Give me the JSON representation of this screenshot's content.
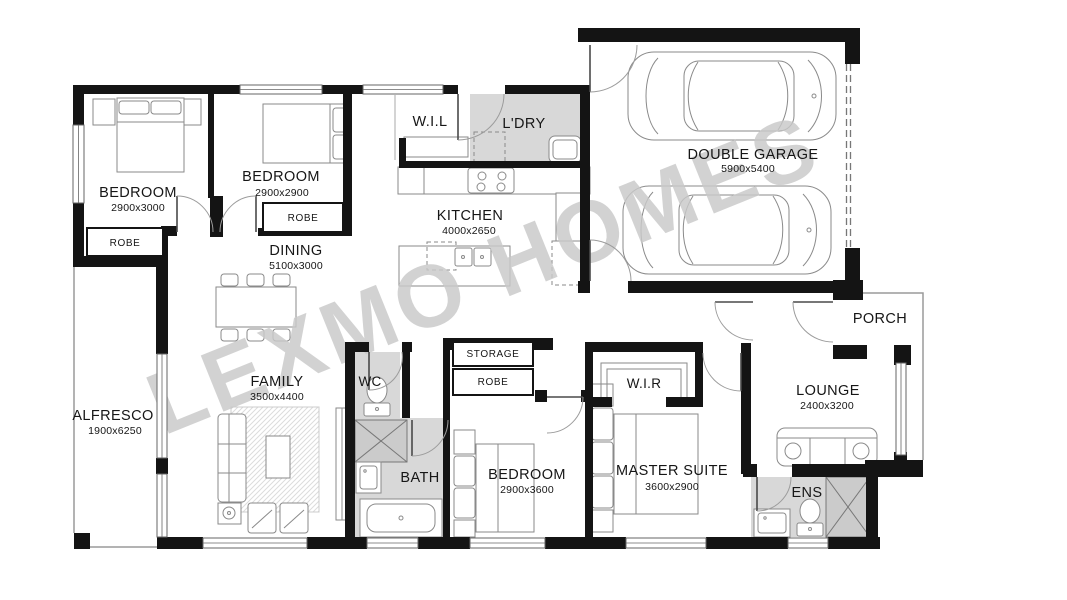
{
  "watermark": "LEXMO HOMES",
  "rooms": {
    "bedroom1": {
      "name": "BEDROOM",
      "dims": "2900x3000"
    },
    "bedroom2": {
      "name": "BEDROOM",
      "dims": "2900x2900"
    },
    "dining": {
      "name": "DINING",
      "dims": "5100x3000"
    },
    "wil": {
      "name": "W.I.L"
    },
    "ldry": {
      "name": "L'DRY"
    },
    "kitchen": {
      "name": "KITCHEN",
      "dims": "4000x2650"
    },
    "garage": {
      "name": "DOUBLE GARAGE",
      "dims": "5900x5400"
    },
    "alfresco": {
      "name": "ALFRESCO",
      "dims": "1900x6250"
    },
    "family": {
      "name": "FAMILY",
      "dims": "3500x4400"
    },
    "wc": {
      "name": "WC"
    },
    "storage": {
      "name": "STORAGE"
    },
    "robe_bed1": {
      "name": "ROBE"
    },
    "robe_bed2": {
      "name": "ROBE"
    },
    "robe_bed3": {
      "name": "ROBE"
    },
    "wir": {
      "name": "W.I.R"
    },
    "bath": {
      "name": "BATH"
    },
    "bedroom3": {
      "name": "BEDROOM",
      "dims": "2900x3600"
    },
    "master": {
      "name": "MASTER SUITE",
      "dims": "3600x2900"
    },
    "lounge": {
      "name": "LOUNGE",
      "dims": "2400x3200"
    },
    "porch": {
      "name": "PORCH"
    },
    "ens": {
      "name": "ENS"
    }
  }
}
